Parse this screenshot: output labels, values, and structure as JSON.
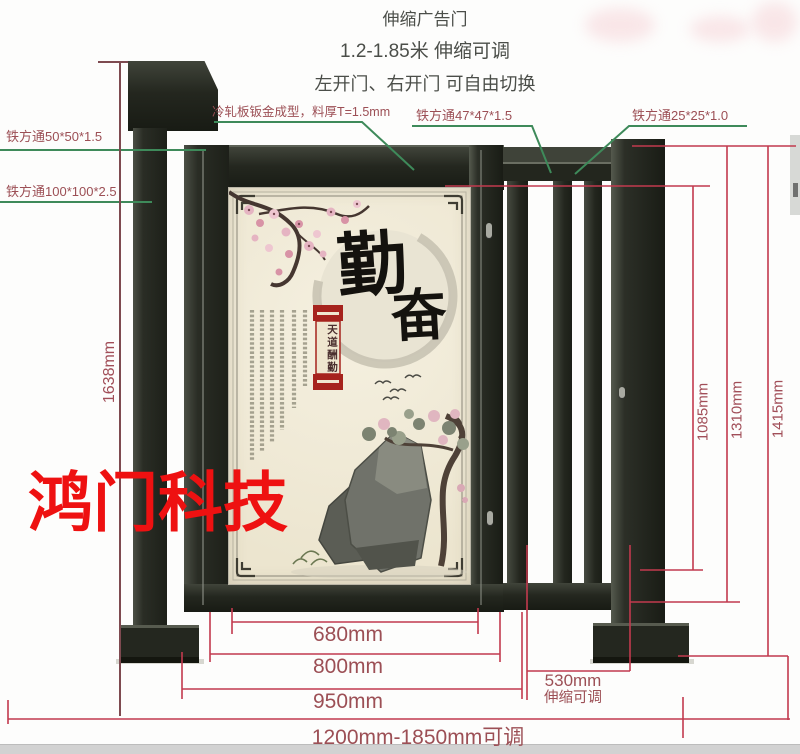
{
  "header": {
    "product_title": "伸缩广告门",
    "size_range": "1.2-1.85米 伸缩可调",
    "door_switch": "左开门、右开门 可自由切换"
  },
  "callouts": {
    "cold_rolled_plate": "冷轧板钣金成型，料厚T=1.5mm",
    "tube_50": "铁方通50*50*1.5",
    "tube_100": "铁方通100*100*2.5",
    "tube_47": "铁方通47*47*1.5",
    "tube_25": "铁方通25*25*1.0"
  },
  "dimensions": {
    "post_height": "1638mm",
    "fence_height": "1085mm",
    "frame_height": "1310mm",
    "total_height": "1415mm",
    "panel_width": "680mm",
    "door_width": "800mm",
    "leaf_width": "950mm",
    "telescopic_width": "530mm",
    "telescopic_note": "伸缩可调",
    "total_range": "1200mm-1850mm可调"
  },
  "watermark": "鸿门科技",
  "panel_art": {
    "calligraphy_char_1": "勤",
    "calligraphy_char_2": "奋",
    "banner_text": "天道酬勤"
  },
  "colors": {
    "steel": "#23261f",
    "panel_cream": "#f1ecd9",
    "dimension_red": "#c23a4e",
    "label_maroon": "#9c4f55",
    "leader_green": "#3e8a5a",
    "watermark_red": "#ee1111"
  }
}
